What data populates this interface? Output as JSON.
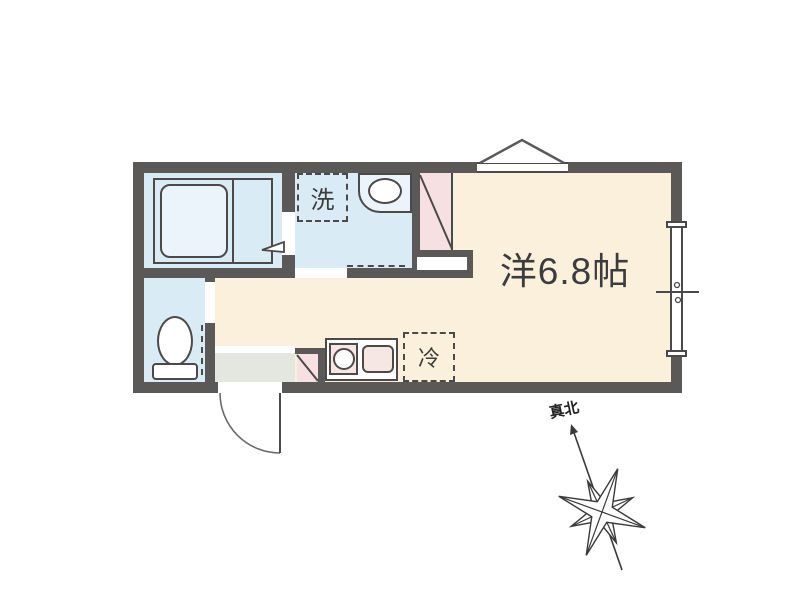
{
  "plan": {
    "main_room_label": "洋6.8帖",
    "washer_label": "洗",
    "fridge_label": "冷",
    "north_label": "真北"
  },
  "colors": {
    "wall": "#5b5858",
    "line": "#4c4949",
    "wet": "#d9ebf5",
    "room": "#faf0dc",
    "pink": "#f7e0e1",
    "pinklight": "#f6e7e3",
    "entry": "#e4e7e0",
    "tub": "#eaf4fa",
    "bg": "#ffffff",
    "text": "#3c3c3c"
  }
}
